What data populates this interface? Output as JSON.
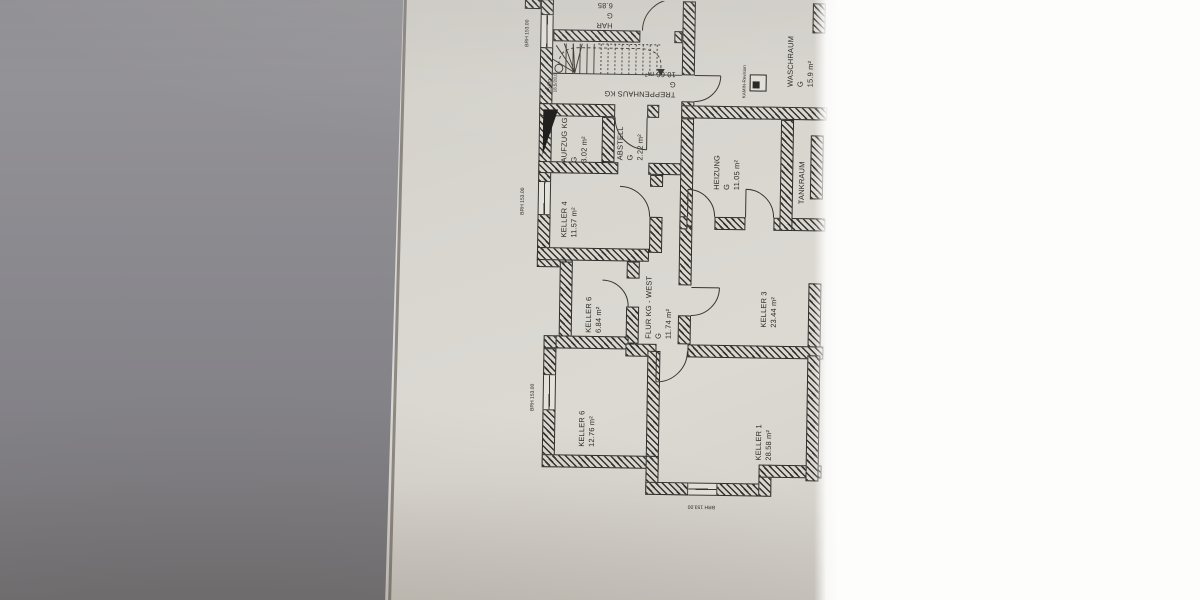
{
  "rooms": {
    "har": {
      "name": "HAR",
      "g": "G",
      "area": "6.85"
    },
    "treppenhaus": {
      "name": "TREPPENHAUS KG",
      "g": "G",
      "area": "10.66 m²"
    },
    "aufzug": {
      "name": "AUFZUG KG",
      "g": "G",
      "area": "3.02 m²"
    },
    "abstell": {
      "name": "ABSTELL",
      "g": "G",
      "area": "2.22 m²"
    },
    "waschraum": {
      "name": "WASCHRAUM",
      "g": "G",
      "area": "15.9 m²"
    },
    "heizung": {
      "name": "HEIZUNG",
      "g": "G",
      "area": "11.05 m²"
    },
    "tankraum": {
      "name": "TANKRAUM"
    },
    "keller4": {
      "name": "KELLER 4",
      "area": "11.57 m²"
    },
    "keller6b": {
      "name": "KELLER 6",
      "area": "6.84 m²"
    },
    "flur": {
      "name": "FLUR KG - WEST",
      "g": "G",
      "area": "11.74 m²"
    },
    "keller3": {
      "name": "KELLER 3",
      "area": "23.44 m²"
    },
    "keller6": {
      "name": "KELLER 6",
      "area": "12.76 m²"
    },
    "keller1": {
      "name": "KELLER 1",
      "area": "28.58 m²"
    }
  },
  "annotations": {
    "brh": "BRH 153.00",
    "stairs_steps": "15 Stg",
    "stairs_dims": "18,5/28,0",
    "kamin": "KAMIN-Revision"
  },
  "colors": {
    "paper": "#d8d5cf",
    "ink": "#2f2d29",
    "table_gray": "#8a898e",
    "overexposed_white": "#fdfdfc"
  }
}
